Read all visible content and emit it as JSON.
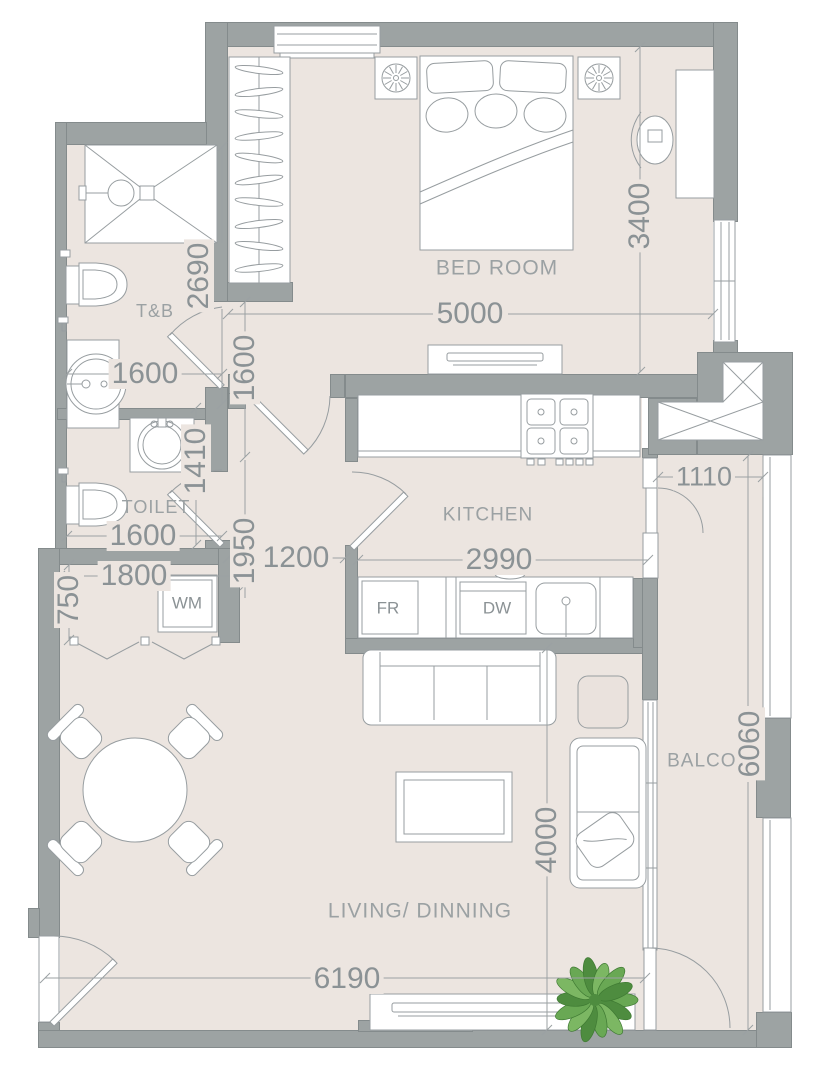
{
  "rooms": {
    "bedroom": "BED ROOM",
    "tb": "T&B",
    "toilet": "TOILET",
    "kitchen": "KITCHEN",
    "living": "LIVING/ DINNING",
    "balcony": "BALCONY"
  },
  "appliances": {
    "washing_machine": "WM",
    "fridge": "FR",
    "dishwasher": "DW"
  },
  "dims": {
    "bedroom_width": "5000",
    "bedroom_depth": "3400",
    "tb_height": "2690",
    "tb_width": "1600",
    "hall_segment": "1600",
    "toilet_depth": "1410",
    "toilet_width": "1600",
    "hall_length": "1950",
    "hall_width": "1200",
    "closet_width": "1800",
    "closet_depth": "750",
    "kitchen_width": "2990",
    "balcony_top_width": "1110",
    "living_depth": "4000",
    "balcony_length": "6060",
    "living_width": "6190"
  },
  "colors": {
    "wall": "#9da3a3",
    "wall_border": "#848b8c",
    "floor": "#ece5e0",
    "line": "#979da0",
    "dim_text": "#8b9295",
    "label_text": "#9ba1a3",
    "plant_green": "#5f9e4b"
  }
}
